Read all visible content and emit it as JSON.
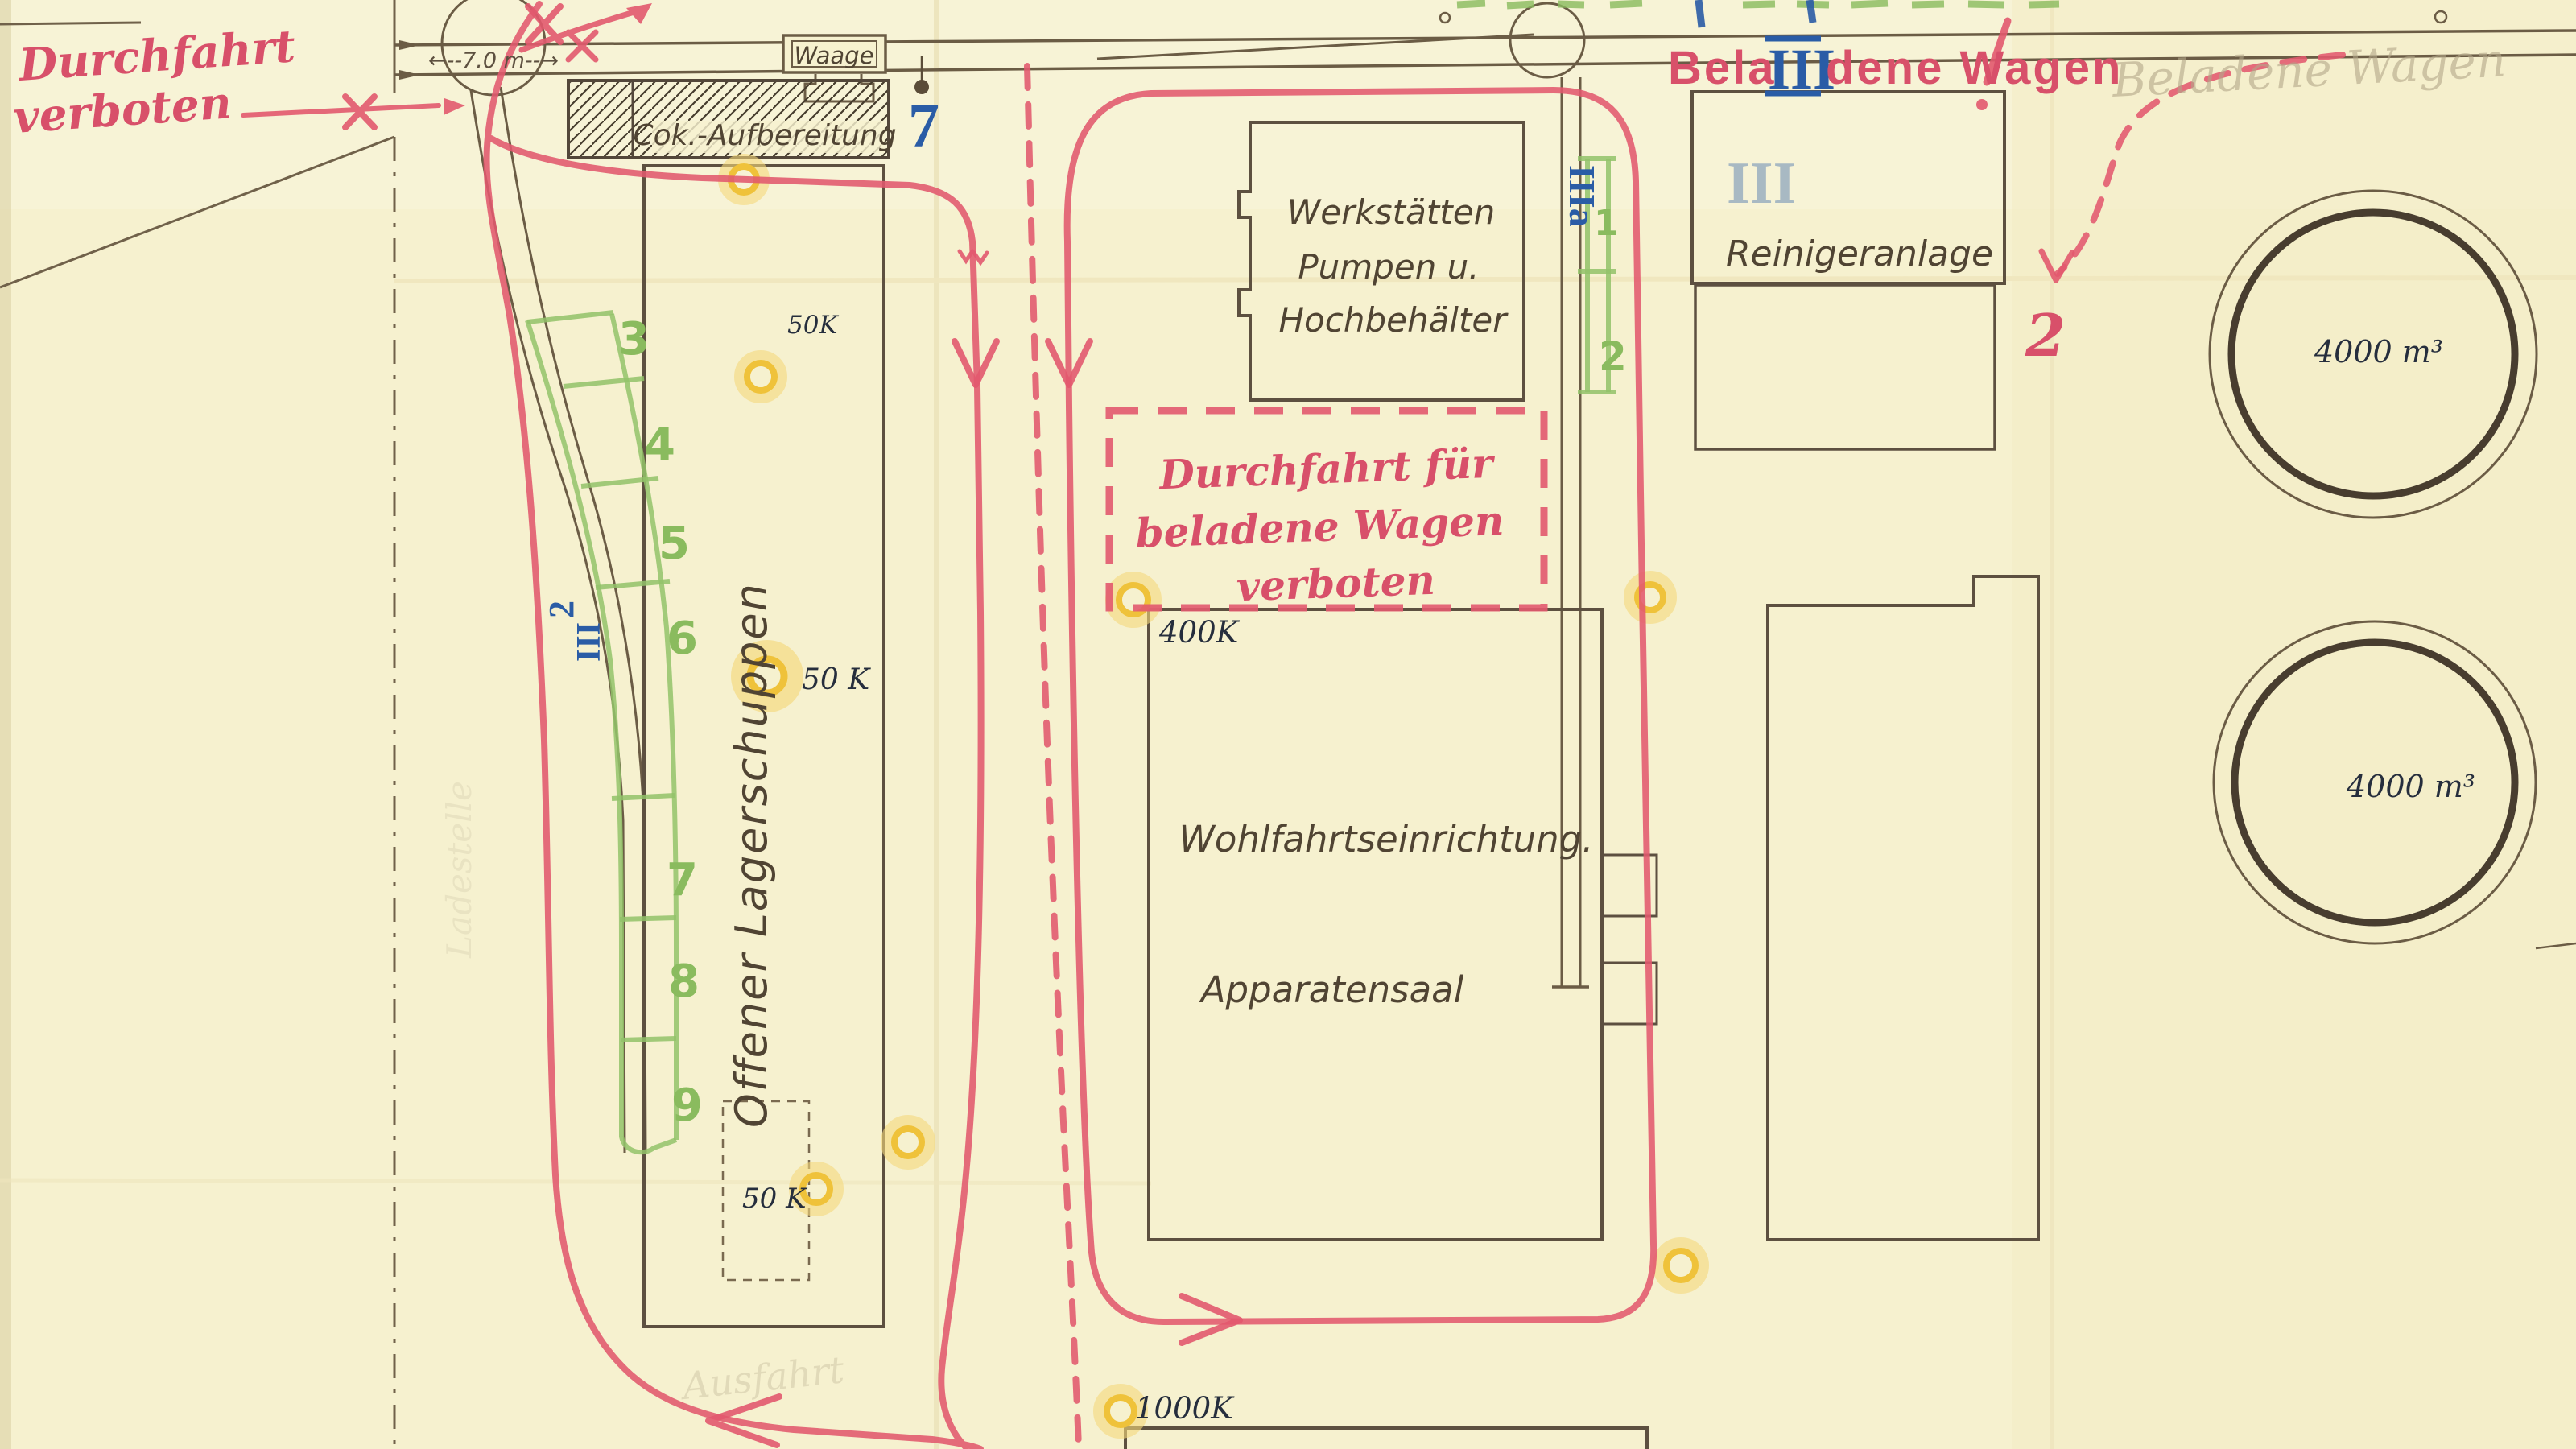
{
  "red": {
    "no_entry_line1": "Durchfahrt",
    "no_entry_line2": "verboten",
    "loaded_pre": "Bela",
    "loaded_roman": "III",
    "loaded_post": "dene Wagen",
    "loaded_excl": "!",
    "box_line1": "Durchfahrt für",
    "box_line2": "beladene Wagen",
    "box_line3": "verboten",
    "num_2": "2"
  },
  "blue": {
    "num_7": "7",
    "iii_a": "IIIa",
    "left_2": "2",
    "left_iii": "III",
    "faint_iii": "III"
  },
  "green": {
    "n1": "1",
    "n2": "2",
    "n3": "3",
    "n4": "4",
    "n5": "5",
    "n6": "6",
    "n7": "7",
    "n8": "8",
    "n9": "9"
  },
  "buildings": {
    "cok": "Cok.-Aufbereitung",
    "waage": "Waage",
    "werk_line1": "Werkstätten",
    "werk_line2": "Pumpen u.",
    "werk_line3": "Hochbehälter",
    "reiniger": "Reinigeranlage",
    "wohlfahrt": "Wohlfahrtseinrichtung.",
    "apparatensaal": "Apparatensaal",
    "lagerschuppen": "Offener Lagerschuppen"
  },
  "markers": {
    "k50_top": "50K",
    "k50_mid": "50 K",
    "k50_low": "50 K",
    "k400": "400K",
    "k1000": "1000K",
    "holder_top": "4000 m³",
    "holder_bottom": "4000 m³"
  },
  "track": {
    "dimension": "←--7.0 m--→"
  },
  "pencil": {
    "beladene_wagen": "Beladene Wagen",
    "ausfahrt": "Ausfahrt",
    "ladestelle": "Ladestelle"
  }
}
